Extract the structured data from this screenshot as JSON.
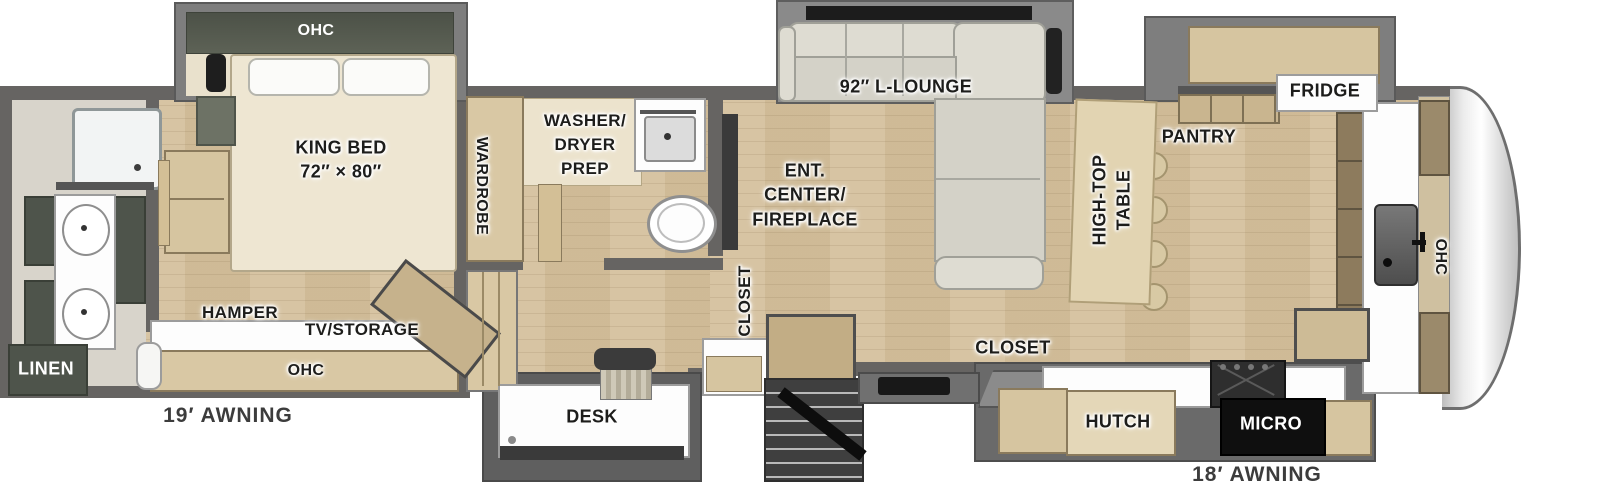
{
  "diagram_type": "rv-fifth-wheel-floorplan",
  "colors": {
    "floor_wood": "#d4c09c",
    "walls": "#666462",
    "cabinet_tan": "#d6c5a0",
    "cabinet_dark_green": "#4e544b",
    "sofa_cream": "#dedcd2",
    "label_text": "#1d1d1b",
    "awning_text": "#3c3c3c"
  },
  "labels": {
    "ohc_bedroom": "OHC",
    "king_bed_1": "KING BED",
    "king_bed_2": "72″ × 80″",
    "wardrobe": "WARDROBE",
    "washer_1": "WASHER/",
    "washer_2": "DRYER",
    "washer_3": "PREP",
    "lounge": "92″ L-LOUNGE",
    "ent_1": "ENT.",
    "ent_2": "CENTER/",
    "ent_3": "FIREPLACE",
    "closet_entry": "CLOSET",
    "hightop_1": "HIGH-TOP",
    "hightop_2": "TABLE",
    "pantry": "PANTRY",
    "fridge": "FRIDGE",
    "ohc_front": "OHC",
    "closet_kitchen": "CLOSET",
    "hutch": "HUTCH",
    "micro": "MICRO",
    "desk": "DESK",
    "linen": "LINEN",
    "hamper": "HAMPER",
    "tv_storage": "TV/STORAGE",
    "ohc_rear": "OHC",
    "awning_left": "19′ AWNING",
    "awning_right": "18′ AWNING"
  }
}
